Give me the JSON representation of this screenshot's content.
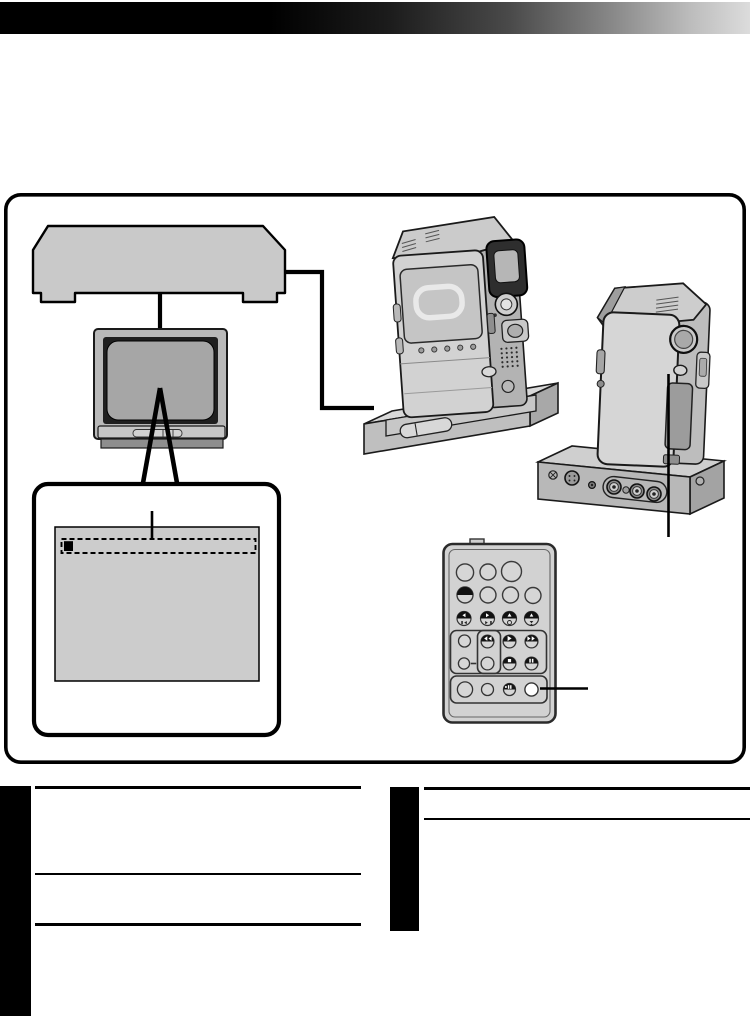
{
  "page": {
    "kind": "instruction-manual-diagram-page",
    "background": "#ffffff",
    "note": "page contains illustration artwork only; no legible text is rendered"
  },
  "header": {
    "bar_gradient_start": "#000000",
    "bar_gradient_end": "#dcdcdc"
  },
  "diagram": {
    "border_color": "#000000",
    "vcr": {
      "label": "video recorder",
      "fill": "#c9c9c9"
    },
    "tv": {
      "label": "tv monitor",
      "frame_fill": "#b9b9b9",
      "bezel_fill": "#1f1f1f",
      "screen_fill": "#a6a6a6",
      "panel_fill": "#c6c6c6",
      "base_fill": "#8e8e8e"
    },
    "screen_callout": {
      "label": "tv screen close-up",
      "box_fill": "#ffffff",
      "screen_fill": "#cccccc",
      "highlight": "dashed selection row with black cursor block",
      "cursor_fill": "#000000"
    },
    "camcorder_front": {
      "label": "camcorder front view docked on docking station"
    },
    "camcorder_rear": {
      "label": "camcorder rear view docked on docking station",
      "jacks": [
        "screw",
        "s-video-jack",
        "mini-jack",
        "rca-jack",
        "rca-jack",
        "rca-jack"
      ]
    },
    "remote": {
      "label": "remote control unit",
      "body_fill": "#d2d2d2",
      "button_fill": "#d6d6d6",
      "dark_button_fill": "#111111",
      "highlighted_button_fill": "#ffffff",
      "button_glyphs": [
        "rewind",
        "play",
        "fast-forward",
        "stop",
        "pause",
        "slow",
        "frame-back",
        "frame-advance"
      ]
    },
    "connections": [
      "vcr-to-tv-cable",
      "vcr-to-docking-station-cable"
    ],
    "callout_lines": [
      "tv-to-screen-closeup",
      "pointer-into-dashed-row",
      "dock-button-pointer",
      "remote-button-pointer"
    ]
  },
  "footer": {
    "left_column_bar_fill": "#000000",
    "right_column_bar_fill": "#000000",
    "rule_color": "#000000"
  }
}
